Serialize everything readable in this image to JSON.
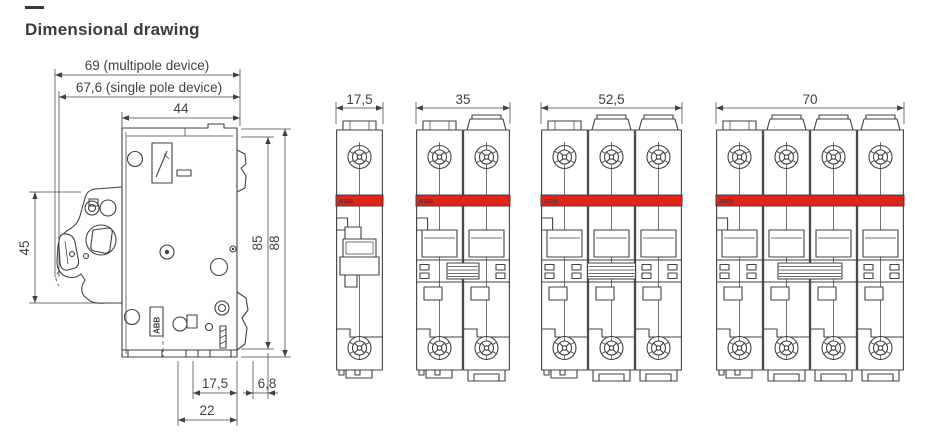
{
  "header": {
    "dash": "—",
    "title": "Dimensional drawing"
  },
  "brand": "ABB",
  "colors": {
    "line": "#414141",
    "brand_red": "#e2231a",
    "brand_text": "#ffffff"
  },
  "side_view": {
    "dims": {
      "width_multipole": "69 (multipole device)",
      "width_singlepole": "67,6 (single pole device)",
      "body_width": "44",
      "handle_height": "45",
      "body_height": "85",
      "total_height": "88",
      "rail_offset": "17,5",
      "clip_depth": "6,8",
      "rail_width": "22"
    }
  },
  "front_views": [
    {
      "label": "17,5",
      "poles": 1
    },
    {
      "label": "35",
      "poles": 2
    },
    {
      "label": "52,5",
      "poles": 3
    },
    {
      "label": "70",
      "poles": 4
    }
  ]
}
